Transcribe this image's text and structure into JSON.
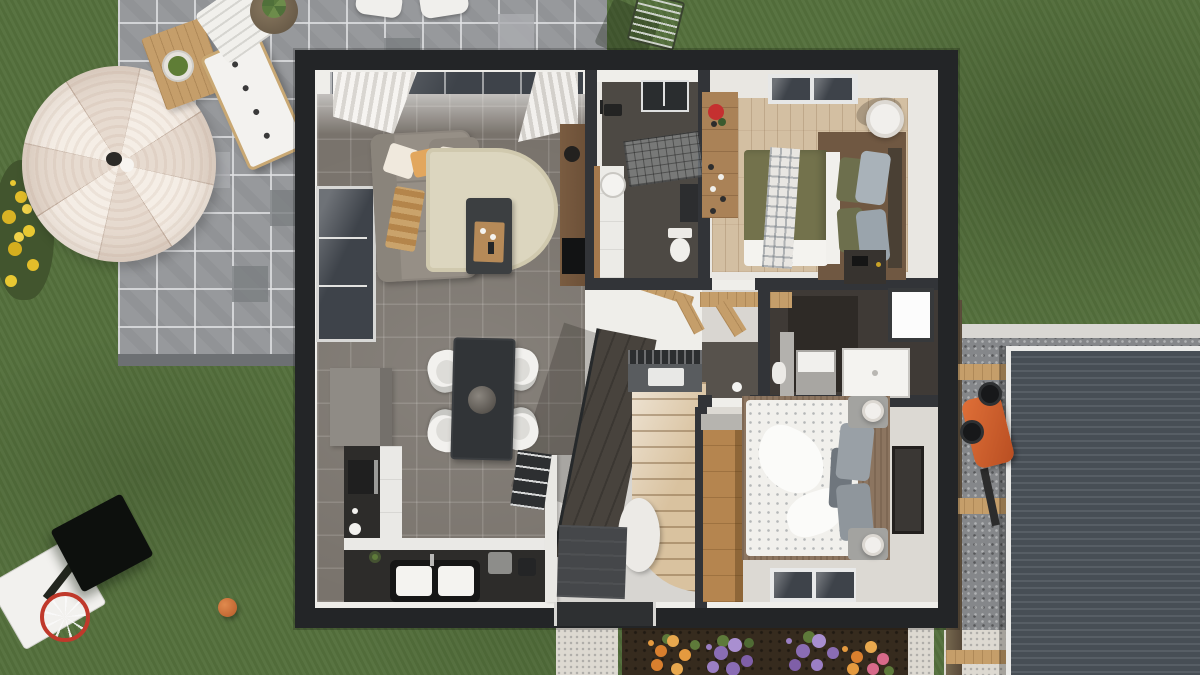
{
  "scene": {
    "title": "Top-down 3D render of a single-storey house with garden",
    "view": "orthographic top view, roof removed",
    "visible_text": "none",
    "areas": [
      "garden-lawn",
      "paver-patio",
      "living-room",
      "dining-area",
      "kitchen",
      "bathroom-main",
      "bedroom-1",
      "hall-bathroom",
      "bedroom-2",
      "entry-hall",
      "staircase",
      "driveway-gravel",
      "carport-roof",
      "flower-bed"
    ],
    "palette": {
      "lawn_green": "#546f3c",
      "paver_gray": "#97999c",
      "exterior_wall_dark": "#232527",
      "interior_wall_white": "#efeeea",
      "living_tile": "#79736c",
      "wood_floor": "#d3bfa2",
      "bathroom_dark_floor": "#4d4944",
      "rug_cream": "#dcd6bf",
      "sofa_gray": "#968f86",
      "duvet_olive": "#73724c",
      "duvet_white": "#f1f0ec",
      "kitchen_counter_dark": "#2d2c2a",
      "stair_wood": "#d9c29f",
      "carport_roof": "#4e555c",
      "umbrella_cream": "#f4ece2",
      "flower_orange": "#e59a3f",
      "flower_purple": "#9b7fc4",
      "flower_yellow": "#e8c832",
      "ball_orange": "#c96a33",
      "mower_orange": "#d86030"
    },
    "outdoor_objects": [
      "parasol-umbrella",
      "garden-table-with-salad-bowl",
      "garden-bench",
      "sun-lounger",
      "potted-aloe",
      "patio-chairs",
      "drying-rack",
      "yellow-flower-bush",
      "basketball-hoop",
      "basketball",
      "lawnmower",
      "wood-beams",
      "flower-bed-clusters",
      "white-gravel-path"
    ],
    "indoor_objects": [
      "corner-sofa",
      "cream-rug",
      "coffee-table",
      "tv-sideboard",
      "curtains",
      "dining-table",
      "dining-chairs-x4",
      "pendant-lamp",
      "kitchen-counters",
      "double-sink",
      "cooker-hood",
      "shower-glass",
      "vanity-sink",
      "toilet",
      "skylight",
      "bed-olive",
      "bed-white",
      "wardrobes",
      "nightstands",
      "drum-lamp",
      "wall-art",
      "winder-staircase",
      "basement-stair-void",
      "door-mat"
    ]
  }
}
